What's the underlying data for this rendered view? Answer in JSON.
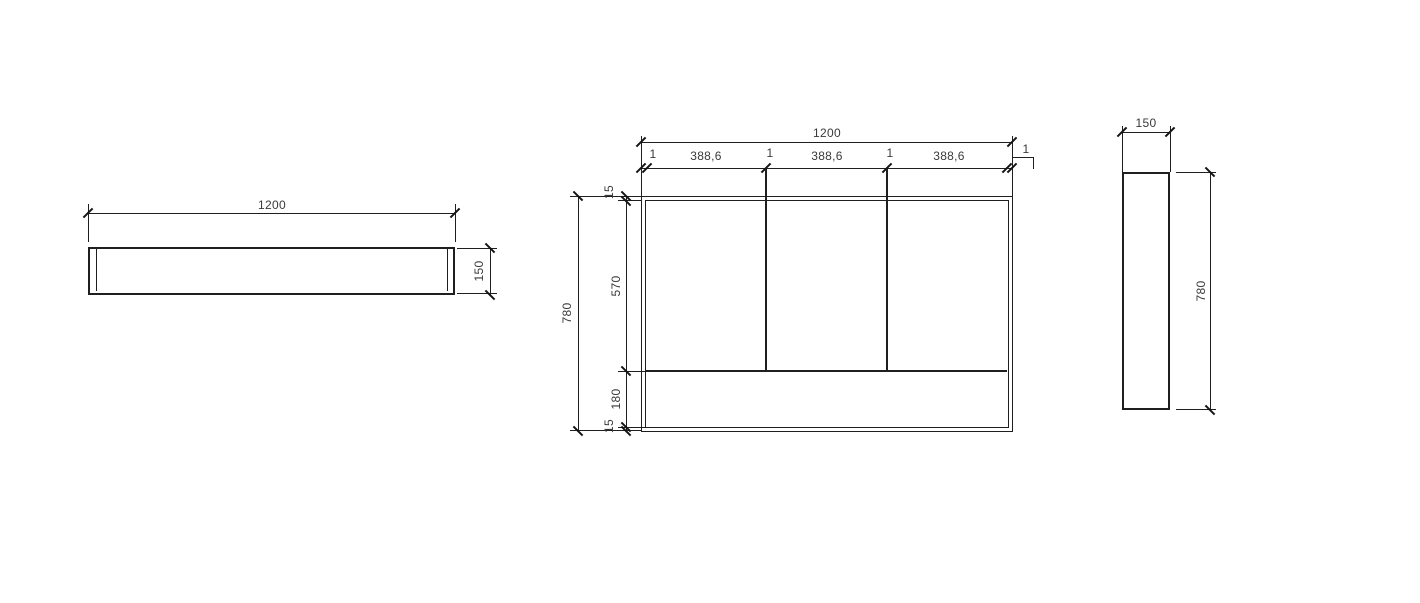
{
  "drawing": {
    "kind": "cad-orthographic-views",
    "background_color": "#ffffff",
    "line_color": "#1f1f1f",
    "text_color": "#3a3a3a",
    "top_view": {
      "length": "1200",
      "depth": "150"
    },
    "front_view": {
      "width": "1200",
      "height": "780",
      "top_chain": [
        "1",
        "388,6",
        "1",
        "388,6",
        "1",
        "388,6",
        "1"
      ],
      "side_chain": [
        "15",
        "570",
        "180",
        "15"
      ]
    },
    "side_view": {
      "depth": "150",
      "height": "780"
    }
  }
}
